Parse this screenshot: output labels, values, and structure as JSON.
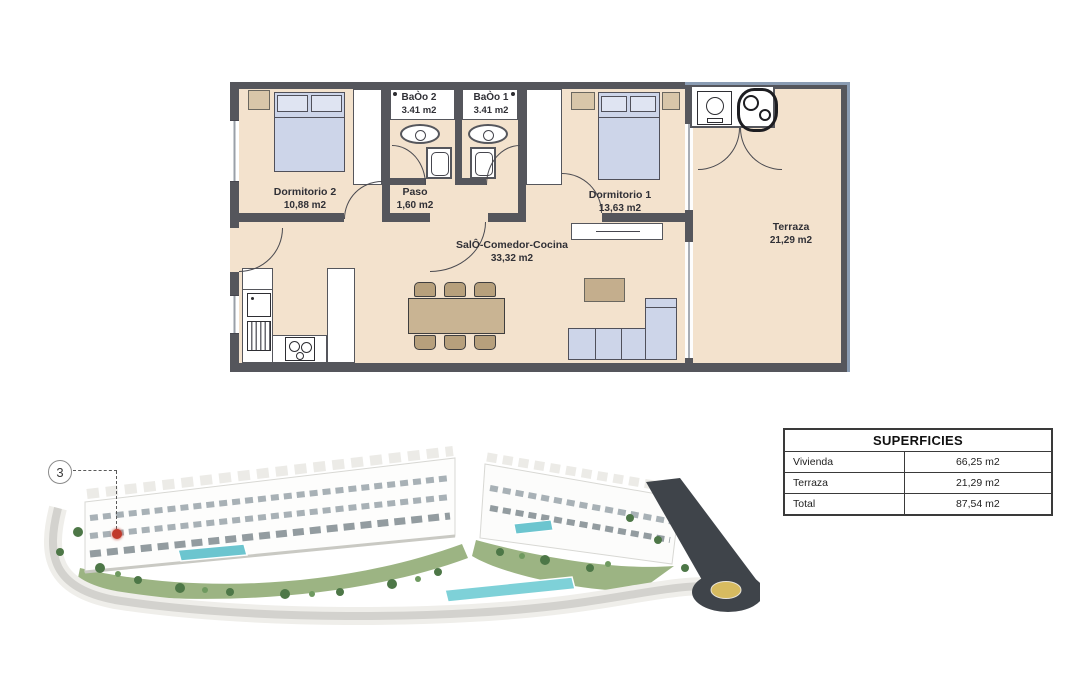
{
  "floor_plan": {
    "rooms": {
      "dormitorio2": {
        "name": "Dormitorio 2",
        "area": "10,88 m2"
      },
      "bano2": {
        "name": "BaÒo 2",
        "area": "3.41 m2"
      },
      "bano1": {
        "name": "BaÒo 1",
        "area": "3.41 m2"
      },
      "paso": {
        "name": "Paso",
        "area": "1,60 m2"
      },
      "dormitorio1": {
        "name": "Dormitorio 1",
        "area": "13,63 m2"
      },
      "salon": {
        "name": "SalÔ-Comedor-Cocina",
        "area": "33,32 m2"
      },
      "terraza": {
        "name": "Terraza",
        "area": "21,29 m2"
      }
    },
    "colors": {
      "floor": "#f3e2cd",
      "wall": "#55565c",
      "furniture_blue": "#cdd5e9",
      "furniture_tan": "#d8c6a9",
      "railing_accent": "#8a9cb3"
    }
  },
  "site_plan": {
    "marker_label": "3",
    "marker_color": "#c0392b"
  },
  "surfaces_table": {
    "title": "SUPERFICIES",
    "rows": [
      {
        "label": "Vivienda",
        "value": "66,25 m2"
      },
      {
        "label": "Terraza",
        "value": "21,29 m2"
      },
      {
        "label": "Total",
        "value": "87,54 m2"
      }
    ]
  }
}
